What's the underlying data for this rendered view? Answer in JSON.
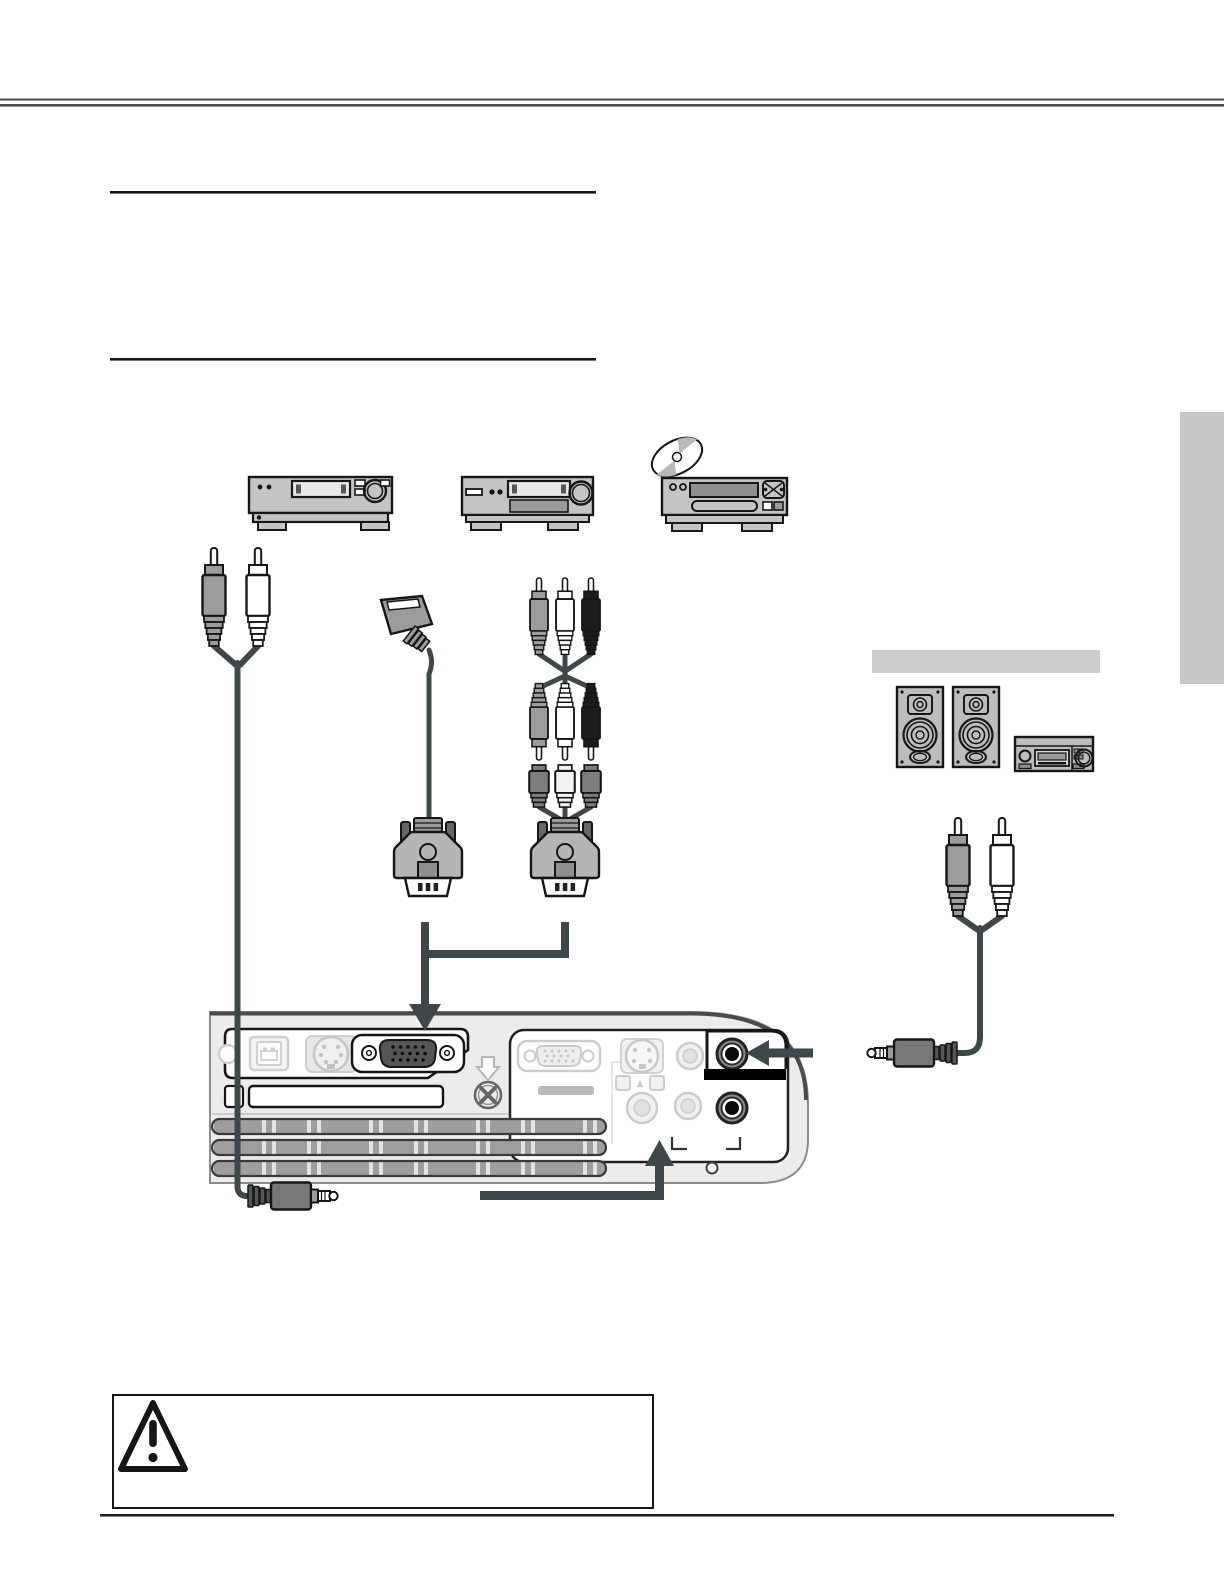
{
  "colors": {
    "page_background": "#ffffff",
    "header_rule": "#4a4a4a",
    "section_rule": "#161616",
    "outline_black": "#161616",
    "cable_and_arrow": "#3e474a",
    "device_body_gray": "#c4c4c4",
    "device_display_gray": "#8f8f8f",
    "rca_plug_gray": "#9c9c9c",
    "rca_plug_white": "#ffffff",
    "rca_plug_black": "#1c1c1c",
    "coupler_dark_gray": "#7d7d7d",
    "vga_connector_gray": "#b5b5b5",
    "vga_dsub_dark": "#565656",
    "projector_body_gray": "#ececec",
    "vent_gray": "#9e9e9e",
    "vent_tick": "#e4e4e4",
    "ghost_connector_gray": "#cccccc",
    "audio_jack_ring_gray": "#8a8a8a",
    "audio_highlight_black": "#000000",
    "minijack_plug_gray": "#787878",
    "speaker_body_gray": "#bdbdbd",
    "equipment_label_bar_gray": "#cccccc",
    "side_tab_gray": "#c8c8c8",
    "footer_rule": "#222222"
  },
  "diagram": {
    "source_devices": [
      {
        "icon": "vcr-icon"
      },
      {
        "icon": "video-player-icon"
      },
      {
        "icon": "dvd-player-icon"
      },
      {
        "icon": "cd-disc-icon"
      }
    ],
    "cables": [
      {
        "icon": "rca-audio-to-minijack-cable-icon"
      },
      {
        "icon": "scart-to-vga-cable-icon"
      },
      {
        "icon": "component-rca-to-vga-cable-icon"
      },
      {
        "icon": "rca-to-minijack-audio-cable-icon"
      }
    ],
    "projector_panel": {
      "left_connectors": [
        "usb-port",
        "din-port",
        "vga-computer-port"
      ],
      "right_connectors": [
        "vga-port",
        "s-video-jack",
        "rca-video-jack",
        "rca-audio-jacks",
        "audio-minijack-top",
        "audio-minijack-bottom"
      ],
      "highlighted_connectors": [
        "vga-computer-port",
        "audio-minijack-top",
        "audio-minijack-bottom"
      ]
    },
    "external_audio_section": {
      "icons": [
        "speaker-icon",
        "speaker-icon",
        "amplifier-icon"
      ]
    },
    "caution_box": {
      "icon": "warning-triangle-icon"
    }
  }
}
